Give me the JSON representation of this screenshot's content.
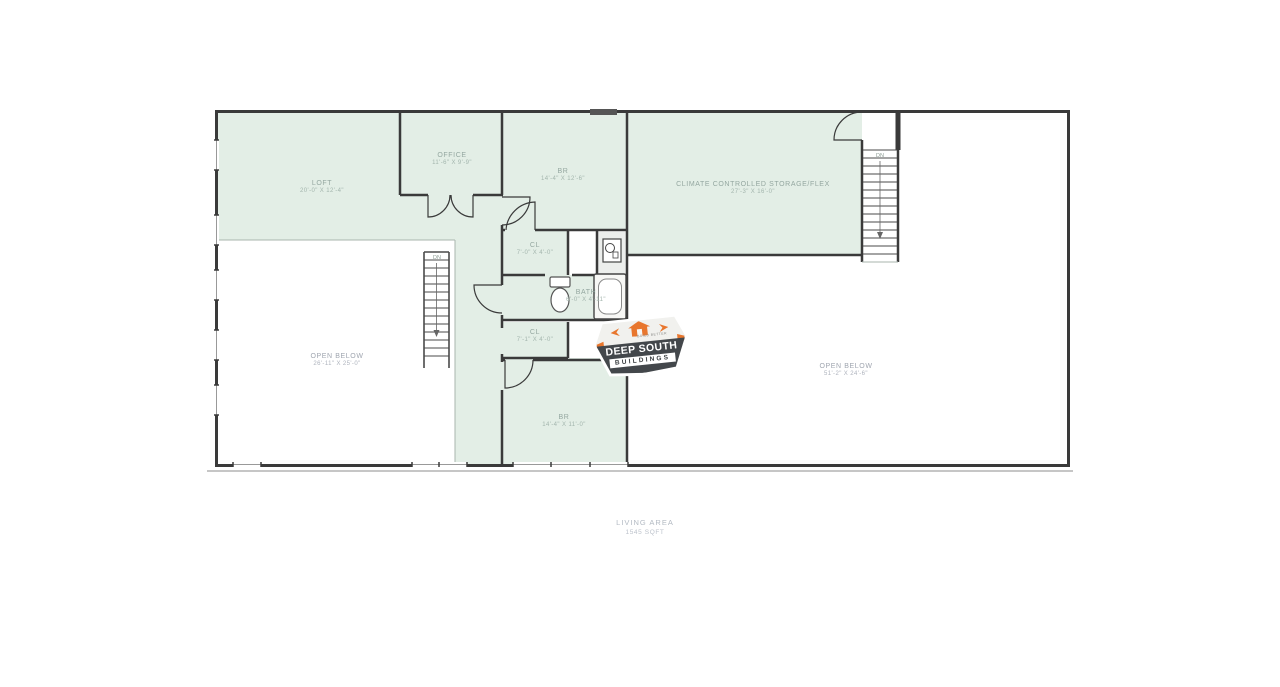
{
  "plan": {
    "rooms": {
      "loft": {
        "name": "LOFT",
        "dims": "20'-0\" X 12'-4\""
      },
      "office": {
        "name": "OFFICE",
        "dims": "11'-6\" X 9'-9\""
      },
      "br_top": {
        "name": "BR",
        "dims": "14'-4\" X 12'-6\""
      },
      "storage": {
        "name": "CLIMATE CONTROLLED STORAGE/FLEX",
        "dims": "27'-3\" X 16'-0\""
      },
      "cl_upper": {
        "name": "CL",
        "dims": "7'-0\" X 4'-0\""
      },
      "bath": {
        "name": "BATH",
        "dims": "6'-0\" X 4'-11\""
      },
      "cl_lower": {
        "name": "CL",
        "dims": "7'-1\" X 4'-0\""
      },
      "br_lower": {
        "name": "BR",
        "dims": "14'-4\" X 11'-0\""
      },
      "open_below_left": {
        "name": "OPEN BELOW",
        "dims": "26'-11\" X 25'-0\""
      },
      "open_below_right": {
        "name": "OPEN BELOW",
        "dims": "51'-2\" X 24'-6\""
      }
    },
    "stairs": {
      "down_label": "DN"
    },
    "summary": {
      "label": "LIVING AREA",
      "value": "1545 SQFT"
    }
  },
  "logo": {
    "line1": "DEEP SOUTH",
    "line2": "BUILDINGS",
    "tagline": "BUILD BETTER"
  },
  "colors": {
    "room_fill": "#e3eee6",
    "wall": "#3a3a3a",
    "room_label": "#94a7a0",
    "open_below_label": "#9fa5af",
    "logo_orange": "#e8762d",
    "logo_charcoal": "#43474b"
  }
}
